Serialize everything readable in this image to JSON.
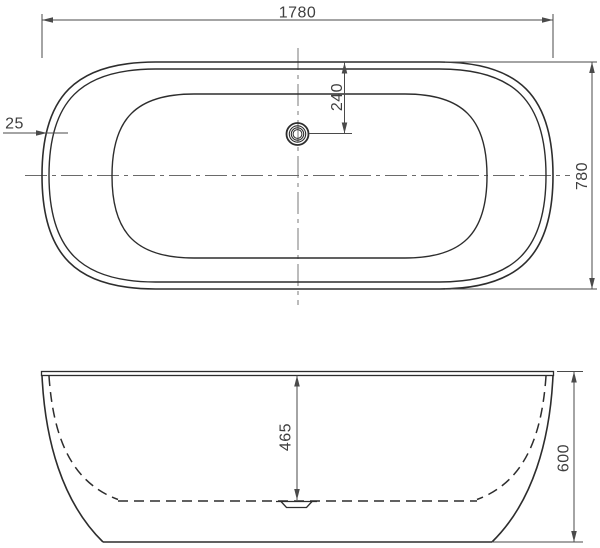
{
  "colors": {
    "background": "#ffffff",
    "outline": "#2d2d2d",
    "dimension_lines": "#4a4a4a",
    "dimension_text": "#3f3f3f"
  },
  "top_view": {
    "dimensions": {
      "overall_length": "1780",
      "overall_width": "780",
      "rim_thickness": "25",
      "drain_offset": "240"
    }
  },
  "side_view": {
    "dimensions": {
      "inner_depth": "465",
      "overall_height": "600"
    }
  }
}
